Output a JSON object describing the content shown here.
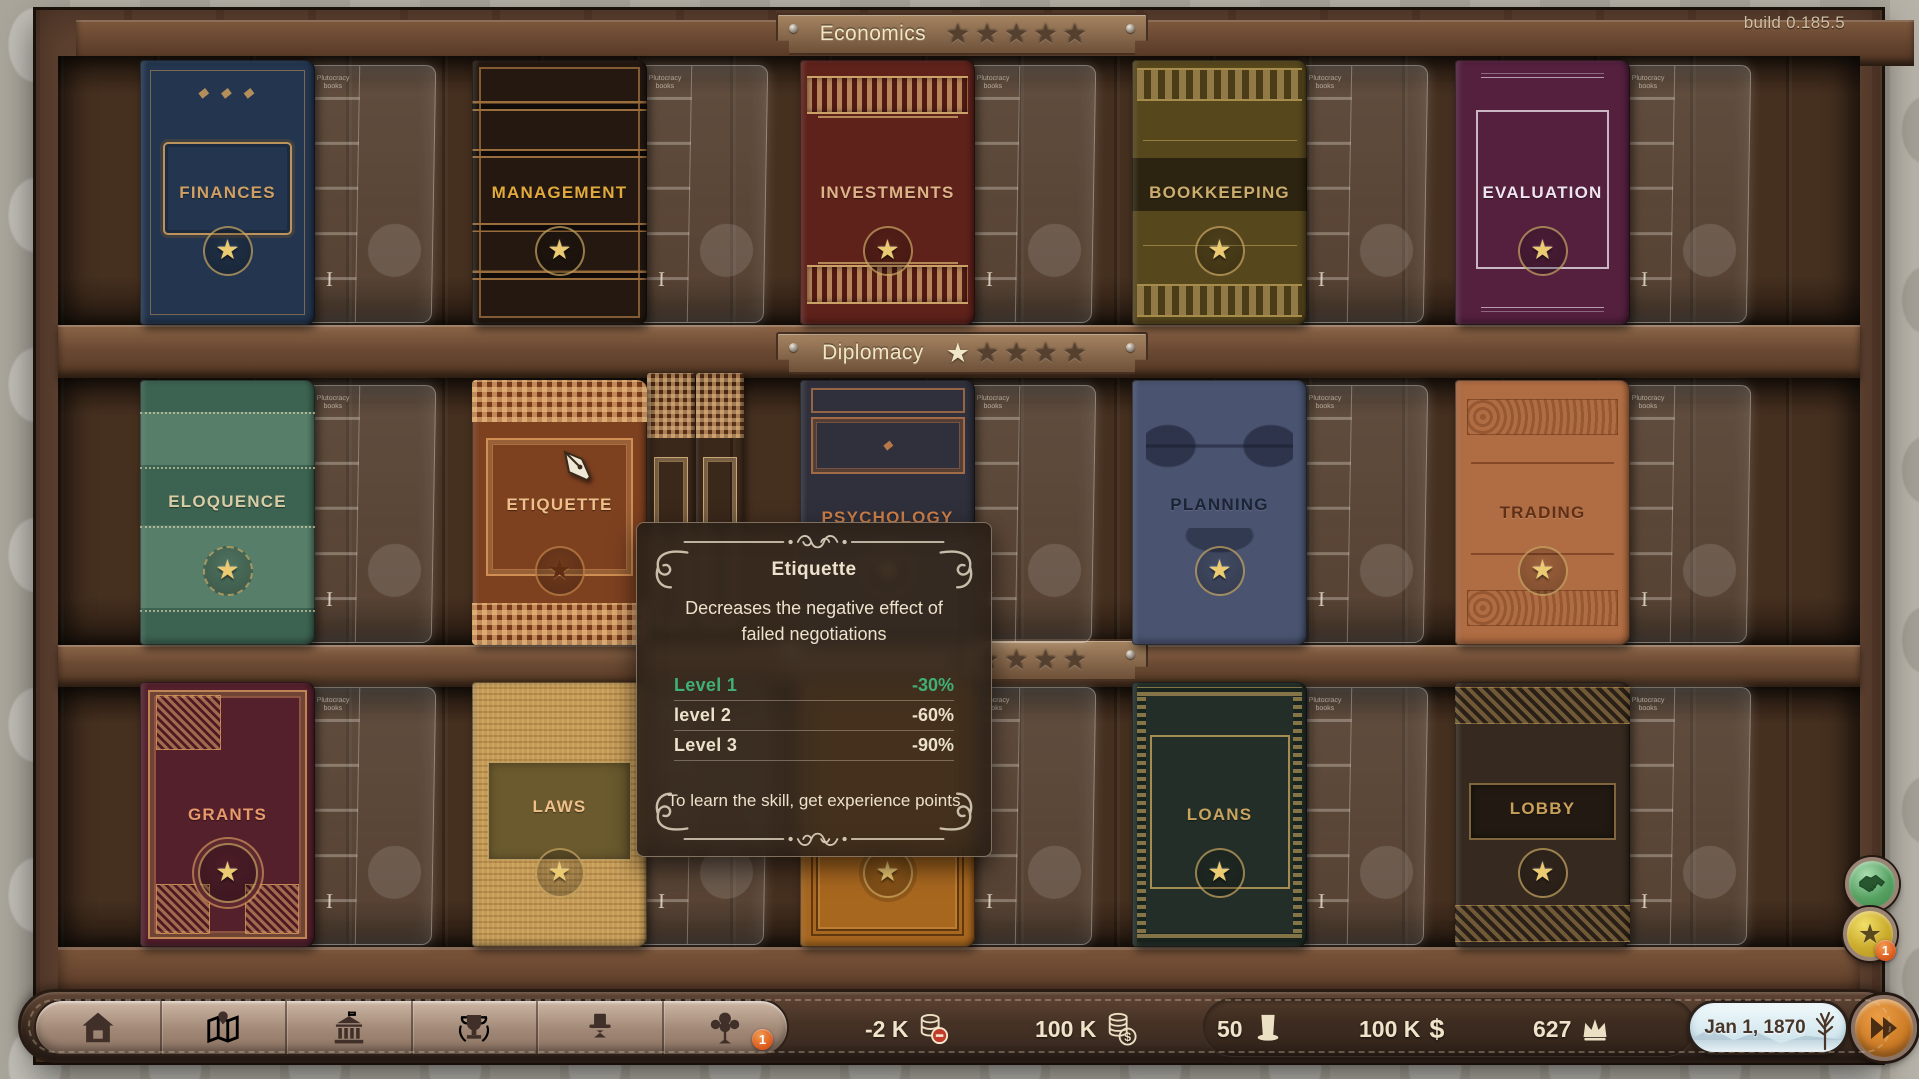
{
  "build_label": "build 0.185.5",
  "ghost": {
    "numeral": "I",
    "label": "Plutocracy books"
  },
  "icons": {
    "star": "★"
  },
  "shelves": [
    {
      "label": "Economics",
      "stars": {
        "filled": 0,
        "total": 5
      },
      "books": [
        {
          "title": "FINANCES",
          "color": "#24364f"
        },
        {
          "title": "MANAGEMENT",
          "color": "#241811"
        },
        {
          "title": "INVESTMENTS",
          "color": "#5f221b"
        },
        {
          "title": "BOOKKEEPING",
          "color": "#57471d"
        },
        {
          "title": "EVALUATION",
          "color": "#54203e"
        }
      ]
    },
    {
      "label": "Diplomacy",
      "stars": {
        "filled": 1,
        "total": 5
      },
      "books": [
        {
          "title": "ELOQUENCE",
          "color": "#3c6351"
        },
        {
          "title": "ETIQUETTE",
          "color": "#7e4120"
        },
        {
          "title": "PSYCHOLOGY",
          "color": "#30303c"
        },
        {
          "title": "PLANNING",
          "color": "#4a5470"
        },
        {
          "title": "TRADING",
          "color": "#b06c42"
        }
      ]
    },
    {
      "label": "",
      "stars": {
        "filled": 0,
        "total": 5
      },
      "books": [
        {
          "title": "GRANTS",
          "color": "#54202c"
        },
        {
          "title": "LAWS",
          "color": "#c49a55"
        },
        {
          "title": "",
          "color": "#a8671f"
        },
        {
          "title": "LOANS",
          "color": "#232e28"
        },
        {
          "title": "LOBBY",
          "color": "#362a20"
        }
      ]
    }
  ],
  "tooltip": {
    "title": "Etiquette",
    "description": "Decreases the negative effect of failed negotiations",
    "levels": [
      {
        "label": "Level 1",
        "value": "-30%",
        "active": true
      },
      {
        "label": "level 2",
        "value": "-60%",
        "active": false
      },
      {
        "label": "Level 3",
        "value": "-90%",
        "active": false
      }
    ],
    "note": "To learn the skill, get experience points",
    "active_color": "#41b075"
  },
  "toolbar": {
    "buttons": [
      {
        "name": "estate"
      },
      {
        "name": "map"
      },
      {
        "name": "government"
      },
      {
        "name": "achievements"
      },
      {
        "name": "character"
      },
      {
        "name": "family-tree",
        "badge": "1"
      }
    ]
  },
  "stats": [
    {
      "value": "-2 K",
      "icon": "coins-minus-icon"
    },
    {
      "value": "100 K",
      "icon": "coins-dollar-icon"
    },
    {
      "value": "50",
      "icon": "top-hat-icon"
    },
    {
      "value": "100 K",
      "icon": "dollar-icon",
      "char": "$"
    },
    {
      "value": "627",
      "icon": "crown-icon"
    }
  ],
  "date": {
    "label": "Jan 1, 1870"
  },
  "side_buttons": [
    {
      "name": "negotiations",
      "badge": ""
    },
    {
      "name": "skills",
      "badge": "1"
    }
  ]
}
